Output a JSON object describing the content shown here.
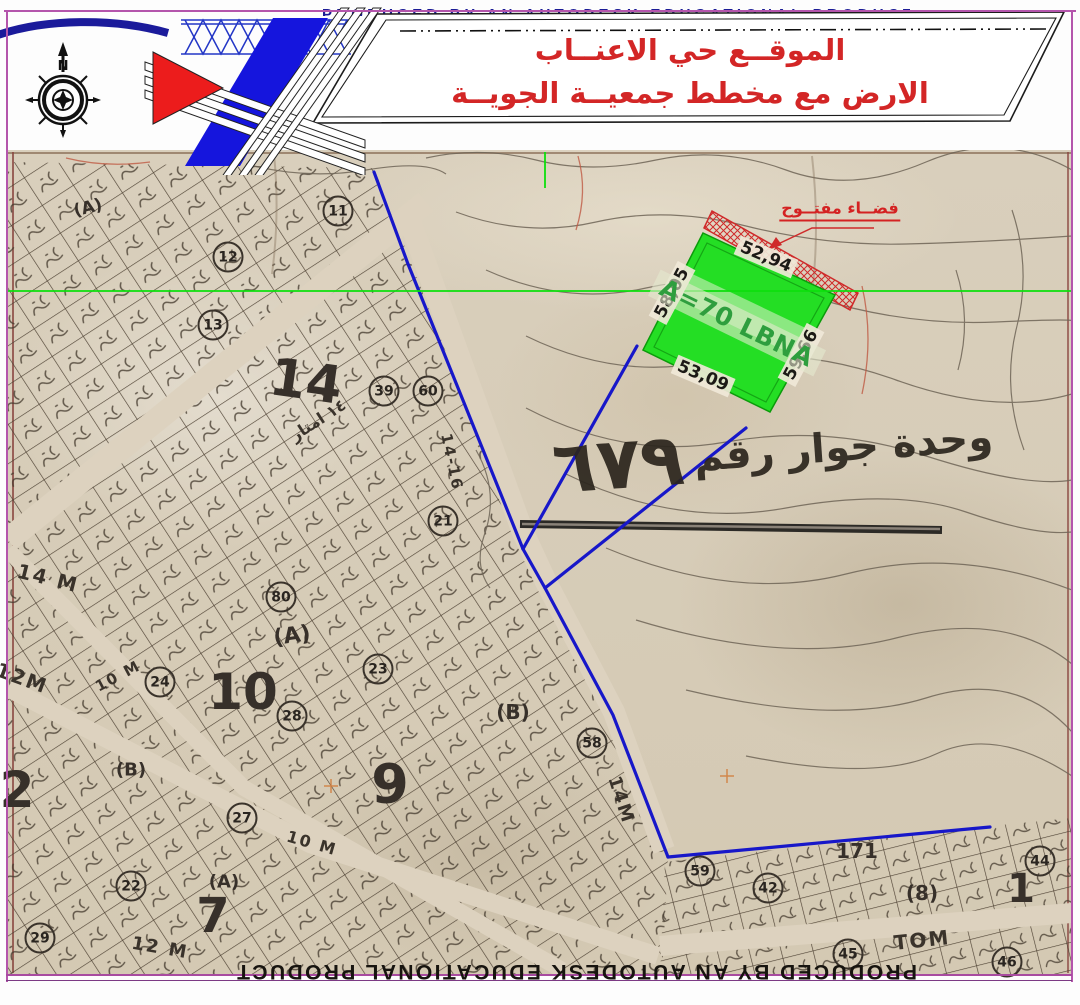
{
  "banner": {
    "autodesk_top": "PRODUCED BY AN AUTODESK EDUCATIONAL PRODUCT",
    "autodesk_bottom": "PRODUCED BY AN AUTODESK EDUCATIONAL PRODUCT",
    "title_line1": "الموقــع حي الاعنــاب",
    "title_line2": "الارض مع مخطط جمعيــة الجويــة",
    "title_color": "#d32626",
    "compass_label": "N"
  },
  "overlay": {
    "open_space_label": "فضــاء مفتــوح",
    "neighborhood": {
      "text": "وحدة جوار رقم",
      "number": "٦٧٩"
    },
    "plot": {
      "area_label": "A=70 LBNA",
      "fill": "#24de24",
      "hatch_color": "#cf2a2a",
      "dim_labels": [
        {
          "t": "52,94",
          "x": 766,
          "y": 257,
          "r": 23
        },
        {
          "t": "58,05",
          "x": 672,
          "y": 293,
          "r": -62
        },
        {
          "t": "59,66",
          "x": 801,
          "y": 355,
          "r": -62
        },
        {
          "t": "53,09",
          "x": 703,
          "y": 376,
          "r": 23
        }
      ]
    },
    "boundary_line_color": "#1717c9",
    "scanline_color": "#0ddf0d"
  },
  "map": {
    "big_numbers": [
      {
        "t": "14",
        "x": 306,
        "y": 382,
        "s": 52,
        "r": 8
      },
      {
        "t": "10",
        "x": 243,
        "y": 692,
        "s": 50,
        "r": 0
      },
      {
        "t": "9",
        "x": 390,
        "y": 784,
        "s": 54,
        "r": 0
      },
      {
        "t": "7",
        "x": 213,
        "y": 916,
        "s": 48,
        "r": 0
      },
      {
        "t": "2",
        "x": 17,
        "y": 790,
        "s": 50,
        "r": 0
      },
      {
        "t": "1",
        "x": 1021,
        "y": 889,
        "s": 40,
        "r": 0
      },
      {
        "t": "171",
        "x": 857,
        "y": 851,
        "s": 20,
        "r": 0
      },
      {
        "t": "(A)",
        "x": 292,
        "y": 636,
        "s": 22,
        "r": -8
      },
      {
        "t": "(B)",
        "x": 513,
        "y": 712,
        "s": 20,
        "r": 0
      },
      {
        "t": "(B)",
        "x": 131,
        "y": 770,
        "s": 18,
        "r": 0
      },
      {
        "t": "(8)",
        "x": 922,
        "y": 893,
        "s": 20,
        "r": 0
      },
      {
        "t": "(A)",
        "x": 224,
        "y": 882,
        "s": 18,
        "r": 0
      },
      {
        "t": "(A)",
        "x": 88,
        "y": 208,
        "s": 17,
        "r": -14
      }
    ],
    "circled_numbers": [
      {
        "t": "11",
        "x": 338,
        "y": 211
      },
      {
        "t": "12",
        "x": 228,
        "y": 257
      },
      {
        "t": "13",
        "x": 213,
        "y": 325
      },
      {
        "t": "39",
        "x": 384,
        "y": 391
      },
      {
        "t": "60",
        "x": 428,
        "y": 391
      },
      {
        "t": "21",
        "x": 443,
        "y": 521
      },
      {
        "t": "80",
        "x": 281,
        "y": 597
      },
      {
        "t": "23",
        "x": 378,
        "y": 669
      },
      {
        "t": "24",
        "x": 160,
        "y": 682
      },
      {
        "t": "28",
        "x": 292,
        "y": 716
      },
      {
        "t": "27",
        "x": 242,
        "y": 818
      },
      {
        "t": "22",
        "x": 131,
        "y": 886
      },
      {
        "t": "29",
        "x": 40,
        "y": 938
      },
      {
        "t": "58",
        "x": 592,
        "y": 743
      },
      {
        "t": "59",
        "x": 700,
        "y": 871
      },
      {
        "t": "42",
        "x": 768,
        "y": 888
      },
      {
        "t": "44",
        "x": 1040,
        "y": 861
      },
      {
        "t": "45",
        "x": 848,
        "y": 954
      },
      {
        "t": "46",
        "x": 1007,
        "y": 962
      }
    ],
    "street_labels": [
      {
        "t": "14 M",
        "x": 48,
        "y": 578,
        "s": 20,
        "r": 14
      },
      {
        "t": "12M",
        "x": 22,
        "y": 678,
        "s": 20,
        "r": 20
      },
      {
        "t": "10 M",
        "x": 118,
        "y": 676,
        "s": 15,
        "r": -28
      },
      {
        "t": "١٤ امتار",
        "x": 318,
        "y": 420,
        "s": 16,
        "r": -33
      },
      {
        "t": "14-16",
        "x": 452,
        "y": 462,
        "s": 15,
        "r": 78
      },
      {
        "t": "14M",
        "x": 621,
        "y": 800,
        "s": 18,
        "r": 72
      },
      {
        "t": "10 M",
        "x": 312,
        "y": 843,
        "s": 16,
        "r": 16
      },
      {
        "t": "12 M",
        "x": 160,
        "y": 948,
        "s": 18,
        "r": 10
      },
      {
        "t": "TOM",
        "x": 922,
        "y": 940,
        "s": 20,
        "r": -6
      }
    ]
  }
}
